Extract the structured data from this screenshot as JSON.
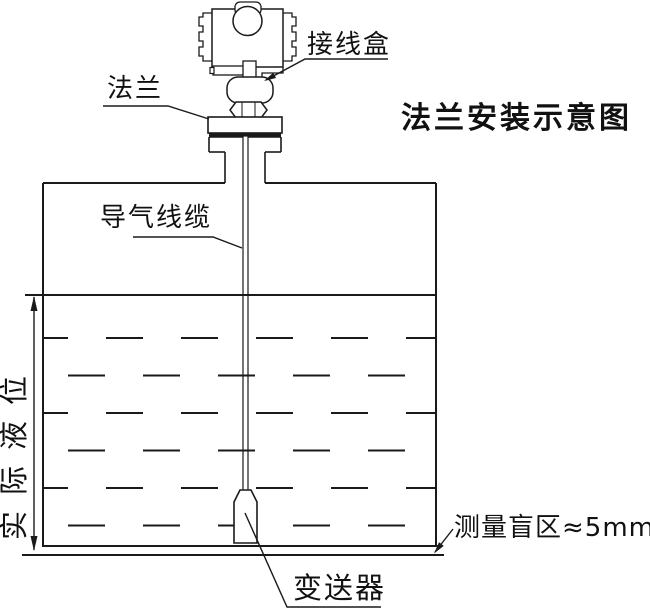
{
  "title": "法兰安装示意图",
  "labels": {
    "junction_box": "接线盒",
    "flange": "法兰",
    "vent_cable": "导气线缆",
    "actual_level": "实际液位",
    "blind_zone": "测量盲区≈5mm",
    "transmitter": "变送器"
  },
  "colors": {
    "line": "#1a1a1a",
    "background": "#ffffff",
    "text": "#111111"
  }
}
